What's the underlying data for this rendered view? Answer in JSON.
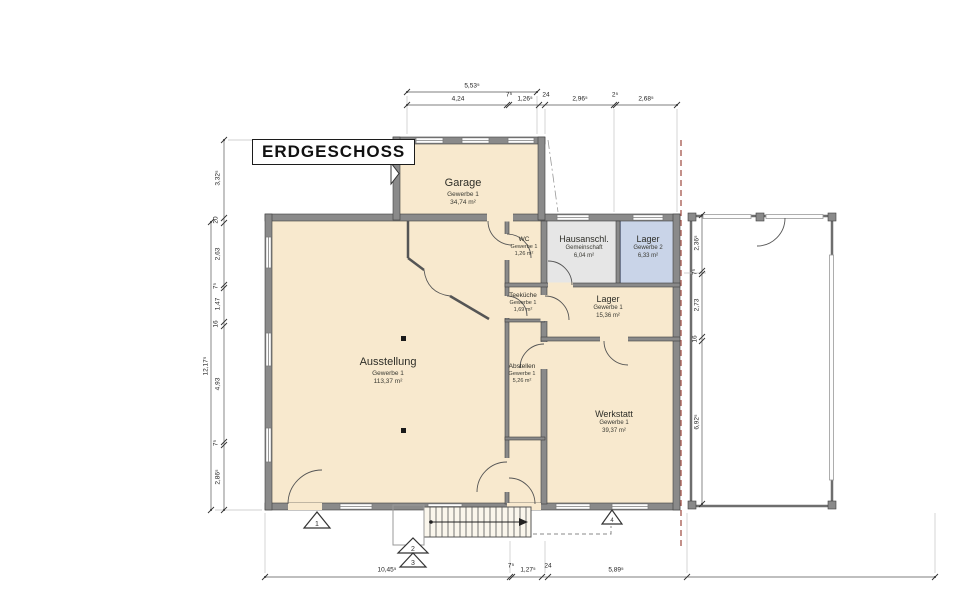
{
  "title": "ERDGESCHOSS",
  "rooms": {
    "garage": {
      "name": "Garage",
      "unit": "Gewerbe 1",
      "area": "34,74 m²"
    },
    "wc": {
      "name": "WC",
      "unit": "Gewerbe 1",
      "area": "1,26 m²"
    },
    "hausanschluss": {
      "name": "Hausanschl.",
      "unit": "Gemeinschaft",
      "area": "6,04 m²"
    },
    "lager_gewerbe2": {
      "name": "Lager",
      "unit": "Gewerbe 2",
      "area": "6,33 m²"
    },
    "teekueche": {
      "name": "Teeküche",
      "unit": "Gewerbe 1",
      "area": "1,69 m²"
    },
    "lager_gewerbe1": {
      "name": "Lager",
      "unit": "Gewerbe 1",
      "area": "15,36 m²"
    },
    "ausstellung": {
      "name": "Ausstellung",
      "unit": "Gewerbe 1",
      "area": "113,37 m²"
    },
    "abstellen": {
      "name": "Abstellen",
      "unit": "Gewerbe 1",
      "area": "5,26 m²"
    },
    "werkstatt": {
      "name": "Werkstatt",
      "unit": "Gewerbe 1",
      "area": "39,37 m²"
    }
  },
  "dimensions": {
    "top": {
      "overall": "5,53⁵",
      "chain": [
        "4,24",
        "7⁵",
        "1,26⁵",
        "24",
        "2,96⁵",
        "2⁵",
        "2,68⁵"
      ]
    },
    "left": {
      "overall": "12,17⁵",
      "chain": [
        "3,32⁵",
        "20",
        "2,63",
        "7⁵",
        "1,47",
        "16",
        "4,93",
        "7⁵",
        "2,86⁵"
      ]
    },
    "right": {
      "chain": [
        "2,36⁵",
        "7⁵",
        "2,73",
        "16",
        "6,92⁵"
      ]
    },
    "bottom": {
      "chain": [
        "10,45⁵",
        "7⁵",
        "1,27⁵",
        "24",
        "5,89⁵"
      ]
    }
  },
  "markers": {
    "entries": [
      "1",
      "2",
      "3",
      "4"
    ]
  },
  "colors": {
    "wall": "#8a8a8a",
    "room_fill": "#f8e9ce",
    "common_fill": "#e6e6e6",
    "storage_fill": "#c9d4e8",
    "section_line": "#a3544a"
  }
}
